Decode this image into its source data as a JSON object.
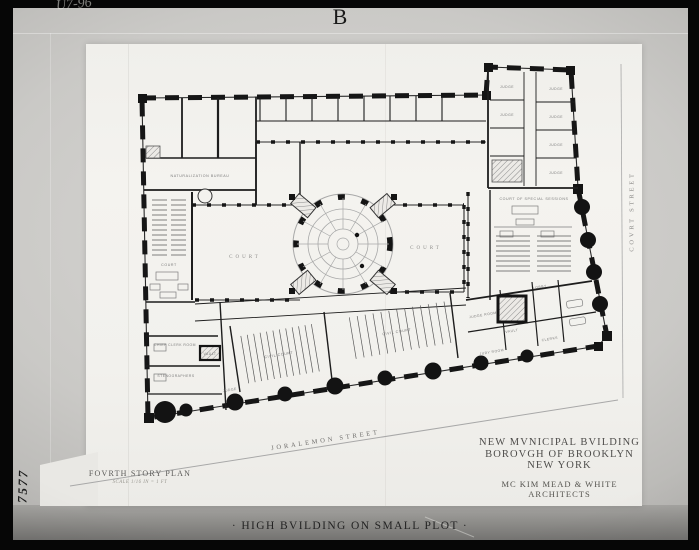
{
  "photo": {
    "plate_letter": "B",
    "caption": "· HIGH BVILDING ON SMALL PLOT ·",
    "handwriting_top_left": "U7-96",
    "handwriting_side": "7577"
  },
  "titles": {
    "building_line1": "NEW MVNICIPAL BVILDING",
    "building_line2": "BOROVGH OF BROOKLYN",
    "building_line3": "NEW YORK",
    "architects_line1": "MC KIM MEAD & WHITE",
    "architects_line2": "ARCHITECTS",
    "plan_title": "FOVRTH STORY PLAN",
    "plan_scale": "SCALE 1/16 IN = 1 FT"
  },
  "streets": {
    "south": "JORALEMON STREET",
    "east": "COVRT STREET"
  },
  "plan_labels": {
    "court_left": "COURT",
    "court_right": "COURT",
    "left_courtroom": "COURT",
    "special_sessions": "COURT OF SPECIAL SESSIONS",
    "naturalization": "NATURALIZATION BUREAU",
    "civil_court": "CIVIL COURT",
    "chief_clerk_room": "CHIEF CLERK ROOM",
    "stenographers": "STENOGRAPHERS",
    "vault": "VAULT",
    "judge": "JUDGE",
    "judge_room": "JUDGE ROOM",
    "lobby": "LOBBY",
    "clerks": "CLERKS",
    "jury_room": "JURY ROOM"
  },
  "colors": {
    "frame": "#060606",
    "mount": "#c6c5c2",
    "paper": "#f3f2ee",
    "ink": "#161616"
  }
}
